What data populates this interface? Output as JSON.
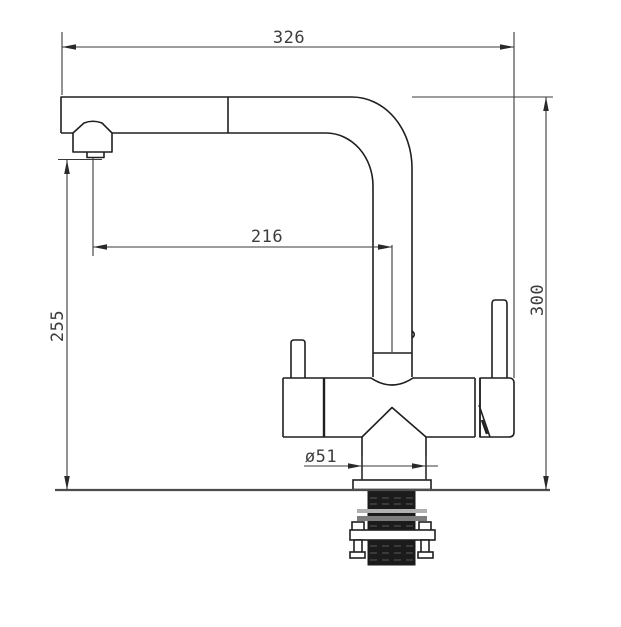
{
  "drawing": {
    "labels": {
      "overall_width": "326",
      "spout_reach": "216",
      "spout_height": "255",
      "overall_height": "300",
      "base_diameter": "ø51"
    }
  }
}
